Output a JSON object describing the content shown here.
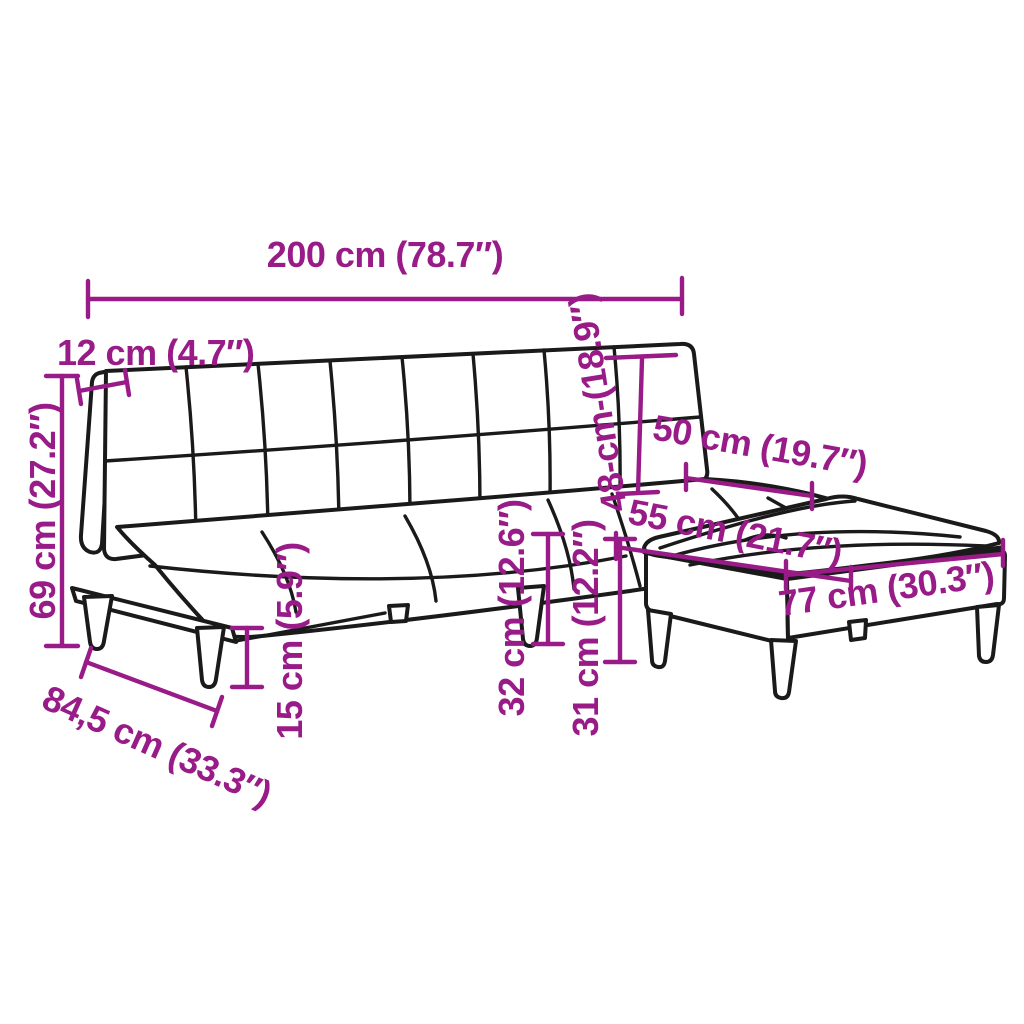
{
  "diagram": {
    "type": "furniture-dimension-diagram",
    "product": "sofa-bed-with-footstool",
    "units": "cm-and-inches",
    "style": {
      "dimension_color": "#981B87",
      "outline_color": "#1A1A1A",
      "background_color": "#FFFFFF"
    },
    "dimensions": {
      "total_width": {
        "label": "200 cm (78.7″)",
        "cm": "200",
        "inches": "78.7"
      },
      "backrest_thickness": {
        "label": "12 cm (4.7″)",
        "cm": "12",
        "inches": "4.7"
      },
      "total_height": {
        "label": "69 cm (27.2″)",
        "cm": "69",
        "inches": "27.2"
      },
      "backrest_height": {
        "label": "48-cm-(18.9″)",
        "cm": "48",
        "inches": "18.9"
      },
      "chaise_seat_width": {
        "label": "50 cm (19.7″)",
        "cm": "50",
        "inches": "19.7"
      },
      "chaise_seat_depth": {
        "label": "55 cm (21.7″)",
        "cm": "55",
        "inches": "21.7"
      },
      "footstool_width": {
        "label": "77 cm (30.3″)",
        "cm": "77",
        "inches": "30.3"
      },
      "seat_height": {
        "label": "32 cm (12.6″)",
        "cm": "32",
        "inches": "12.6"
      },
      "footstool_height": {
        "label": "31 cm (12.2″)",
        "cm": "31",
        "inches": "12.2"
      },
      "leg_height": {
        "label": "15 cm (5.9″)",
        "cm": "15",
        "inches": "5.9"
      },
      "seat_depth": {
        "label": "84,5 cm (33.3″)",
        "cm": "84,5",
        "inches": "33.3"
      }
    }
  }
}
